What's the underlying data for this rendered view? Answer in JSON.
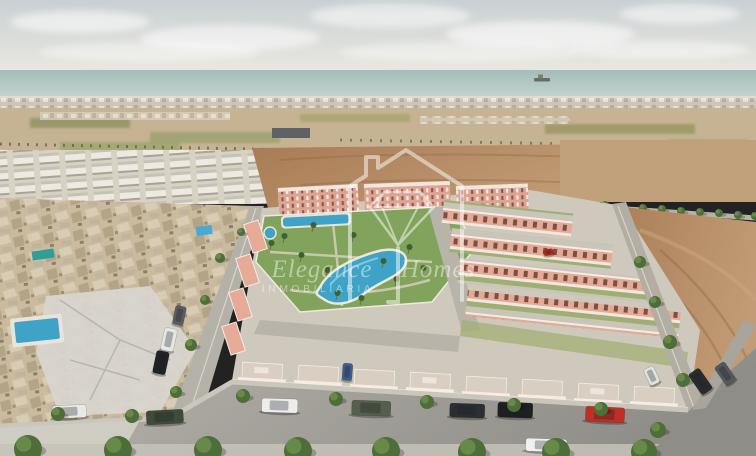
{
  "image": {
    "width": 756,
    "height": 456,
    "type": "real-estate-aerial-render",
    "alt": "Aerial 3D render of a new-build residential development of salmon-pink villas with a central landscaped pool park, an older beige village to the left, empty brown building plots to the right, farmland and the sea on the horizon, and cars parked along the front road"
  },
  "watermark": {
    "brand_word_1": "Elegance",
    "brand_word_2": "Homes",
    "subtitle": "INMOBILIARIA",
    "logo_icon": "house-diamond-logo",
    "color": "#ffffff"
  },
  "palette": {
    "sky_top": "#c9d0d3",
    "sky_bottom": "#ece9e1",
    "sea": "#a4bdb9",
    "sea_light": "#c6d6d0",
    "sand": "#e2dbc9",
    "farmland": "#c6b393",
    "olive": "#8e9160",
    "dirt": "#a87c55",
    "dirt_light": "#c29c76",
    "old_town": "#cabb9f",
    "white_houses": "#ebe8df",
    "villa_wall": "#e5ab97",
    "villa_trim": "#f7ebe3",
    "shutter": "#7d8d66",
    "park_green": "#7fa258",
    "pool_blue": "#3fa3c7",
    "road": "#a3a19b",
    "sidewalk": "#cfccc3",
    "tree_dark": "#4d6d39",
    "tree_light": "#6d8f4b"
  },
  "scene": {
    "clouds": [
      {
        "x": 80,
        "y": 22,
        "rx": 70,
        "ry": 11,
        "o": 0.55
      },
      {
        "x": 230,
        "y": 38,
        "rx": 90,
        "ry": 13,
        "o": 0.5
      },
      {
        "x": 390,
        "y": 16,
        "rx": 80,
        "ry": 12,
        "o": 0.5
      },
      {
        "x": 540,
        "y": 34,
        "rx": 95,
        "ry": 13,
        "o": 0.55
      },
      {
        "x": 680,
        "y": 14,
        "rx": 60,
        "ry": 10,
        "o": 0.5
      },
      {
        "x": 150,
        "y": 52,
        "rx": 110,
        "ry": 10,
        "o": 0.4
      },
      {
        "x": 460,
        "y": 52,
        "rx": 120,
        "ry": 10,
        "o": 0.4
      },
      {
        "x": 660,
        "y": 50,
        "rx": 90,
        "ry": 9,
        "o": 0.45
      }
    ],
    "roadside_trees": [
      {
        "x": 472,
        "y": 196
      },
      {
        "x": 491,
        "y": 197
      },
      {
        "x": 510,
        "y": 199
      },
      {
        "x": 529,
        "y": 200
      },
      {
        "x": 548,
        "y": 201
      },
      {
        "x": 567,
        "y": 203
      },
      {
        "x": 586,
        "y": 204
      },
      {
        "x": 605,
        "y": 205
      },
      {
        "x": 624,
        "y": 207
      },
      {
        "x": 643,
        "y": 208
      },
      {
        "x": 662,
        "y": 209
      },
      {
        "x": 681,
        "y": 211
      },
      {
        "x": 700,
        "y": 212
      },
      {
        "x": 719,
        "y": 213
      },
      {
        "x": 738,
        "y": 215
      },
      {
        "x": 755,
        "y": 216
      }
    ],
    "street_trees": [
      {
        "x": 241,
        "y": 232,
        "r": 4
      },
      {
        "x": 220,
        "y": 258,
        "r": 5
      },
      {
        "x": 205,
        "y": 300,
        "r": 5
      },
      {
        "x": 191,
        "y": 345,
        "r": 6
      },
      {
        "x": 176,
        "y": 392,
        "r": 6
      },
      {
        "x": 640,
        "y": 262,
        "r": 6
      },
      {
        "x": 655,
        "y": 302,
        "r": 6
      },
      {
        "x": 670,
        "y": 342,
        "r": 7
      },
      {
        "x": 683,
        "y": 380,
        "r": 7
      },
      {
        "x": 58,
        "y": 414,
        "r": 7
      },
      {
        "x": 132,
        "y": 416,
        "r": 7
      },
      {
        "x": 243,
        "y": 396,
        "r": 7
      },
      {
        "x": 336,
        "y": 399,
        "r": 7
      },
      {
        "x": 427,
        "y": 402,
        "r": 7
      },
      {
        "x": 514,
        "y": 405,
        "r": 7
      },
      {
        "x": 601,
        "y": 409,
        "r": 7
      },
      {
        "x": 658,
        "y": 430,
        "r": 8
      }
    ],
    "bottom_trees": [
      {
        "x": 28,
        "y": 449,
        "r": 14
      },
      {
        "x": 118,
        "y": 450,
        "r": 14
      },
      {
        "x": 208,
        "y": 450,
        "r": 14
      },
      {
        "x": 298,
        "y": 451,
        "r": 14
      },
      {
        "x": 386,
        "y": 451,
        "r": 14
      },
      {
        "x": 472,
        "y": 452,
        "r": 14
      },
      {
        "x": 556,
        "y": 452,
        "r": 14
      },
      {
        "x": 644,
        "y": 452,
        "r": 13
      }
    ],
    "palms": [
      {
        "x": 283,
        "y": 243
      },
      {
        "x": 300,
        "y": 262
      },
      {
        "x": 326,
        "y": 277
      },
      {
        "x": 352,
        "y": 242
      },
      {
        "x": 382,
        "y": 268
      },
      {
        "x": 408,
        "y": 254
      },
      {
        "x": 336,
        "y": 300
      },
      {
        "x": 312,
        "y": 232
      },
      {
        "x": 395,
        "y": 286
      },
      {
        "x": 270,
        "y": 250
      },
      {
        "x": 360,
        "y": 305
      },
      {
        "x": 422,
        "y": 275
      }
    ],
    "cars": [
      {
        "x": 52,
        "y": 406,
        "w": 34,
        "h": 13,
        "c": "#e9e9e7",
        "a": -3
      },
      {
        "x": 146,
        "y": 411,
        "w": 37,
        "h": 14,
        "c": "#3e4c39",
        "a": -3
      },
      {
        "x": 165,
        "y": 327,
        "w": 13,
        "h": 23,
        "c": "#e6e6e4",
        "a": 12
      },
      {
        "x": 157,
        "y": 350,
        "w": 13,
        "h": 23,
        "c": "#202226",
        "a": 12
      },
      {
        "x": 176,
        "y": 305,
        "w": 11,
        "h": 19,
        "c": "#595d62",
        "a": 12
      },
      {
        "x": 262,
        "y": 398,
        "w": 36,
        "h": 14,
        "c": "#ededeb",
        "a": 2
      },
      {
        "x": 352,
        "y": 400,
        "w": 39,
        "h": 15,
        "c": "#555f4e",
        "a": 2
      },
      {
        "x": 450,
        "y": 403,
        "w": 35,
        "h": 14,
        "c": "#2c2e31",
        "a": 2
      },
      {
        "x": 498,
        "y": 402,
        "w": 35,
        "h": 15,
        "c": "#1d1f21",
        "a": 2
      },
      {
        "x": 586,
        "y": 406,
        "w": 39,
        "h": 15,
        "c": "#bf2f25",
        "a": 3
      },
      {
        "x": 526,
        "y": 438,
        "w": 41,
        "h": 13,
        "c": "#f1f1ef",
        "a": 2
      },
      {
        "x": 688,
        "y": 375,
        "w": 13,
        "h": 25,
        "c": "#292b2f",
        "a": -35
      },
      {
        "x": 714,
        "y": 368,
        "w": 12,
        "h": 22,
        "c": "#54575b",
        "a": -35
      },
      {
        "x": 343,
        "y": 363,
        "w": 10,
        "h": 17,
        "c": "#3e5d8d",
        "a": 4
      },
      {
        "x": 643,
        "y": 370,
        "w": 11,
        "h": 18,
        "c": "#e1e1df",
        "a": -25
      },
      {
        "x": 543,
        "y": 250,
        "w": 10,
        "h": 6,
        "c": "#b4271d",
        "a": -10
      }
    ],
    "front_villas": [
      {
        "x": 238,
        "y": 377
      },
      {
        "x": 294,
        "y": 380
      },
      {
        "x": 350,
        "y": 384
      },
      {
        "x": 406,
        "y": 387
      },
      {
        "x": 462,
        "y": 391
      },
      {
        "x": 518,
        "y": 394
      },
      {
        "x": 574,
        "y": 398
      },
      {
        "x": 630,
        "y": 401
      }
    ]
  }
}
